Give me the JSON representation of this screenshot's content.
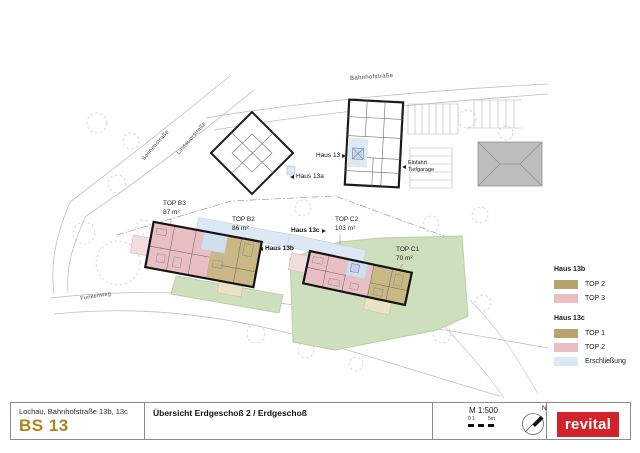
{
  "plan": {
    "streets": {
      "top": "Bahnhofstraße",
      "left_upper": "Sonnenstraße",
      "left_lower": "Lindauerstraße",
      "bottom": "Funkenweg"
    },
    "buildings": {
      "haus_13": "Haus 13",
      "haus_13a": "Haus 13a",
      "haus_13b": "Haus 13b",
      "haus_13c": "Haus 13c"
    },
    "garage_entry": {
      "line1": "Einfahrt",
      "line2": "Tiefgarage"
    },
    "units": [
      {
        "label": "TOP B3",
        "area": "87 m²"
      },
      {
        "label": "TOP B2",
        "area": "86 m²"
      },
      {
        "label": "TOP C2",
        "area": "103 m²"
      },
      {
        "label": "TOP C1",
        "area": "70 m²"
      }
    ]
  },
  "legend": {
    "groups": [
      {
        "title": "Haus 13b",
        "items": [
          {
            "label": "TOP 2",
            "color": "#b7a46d"
          },
          {
            "label": "TOP 3",
            "color": "#e9bfc3"
          }
        ]
      },
      {
        "title": "Haus 13c",
        "items": [
          {
            "label": "TOP 1",
            "color": "#b7a46d"
          },
          {
            "label": "TOP 2",
            "color": "#e9bfc3"
          },
          {
            "label": "Erschließung",
            "color": "#dce8f4"
          }
        ]
      }
    ]
  },
  "titleblock": {
    "address": "Lochau, Bahnhofstraße 13b, 13c",
    "code": "BS 13",
    "sheet_title": "Übersicht Erdgeschoß 2 / Erdgeschoß",
    "scale": "M 1:500",
    "scalebar_left": "0 1",
    "scalebar_right": "5m",
    "north": "N",
    "logo": "revital"
  },
  "colors": {
    "accent_gold": "#ad851a",
    "logo_red": "#d2232a",
    "tan": "#b7a46d",
    "pink": "#e9bfc3",
    "circulation_blue": "#dce8f4",
    "green": "#cddfbc",
    "wall_black": "#141414"
  }
}
